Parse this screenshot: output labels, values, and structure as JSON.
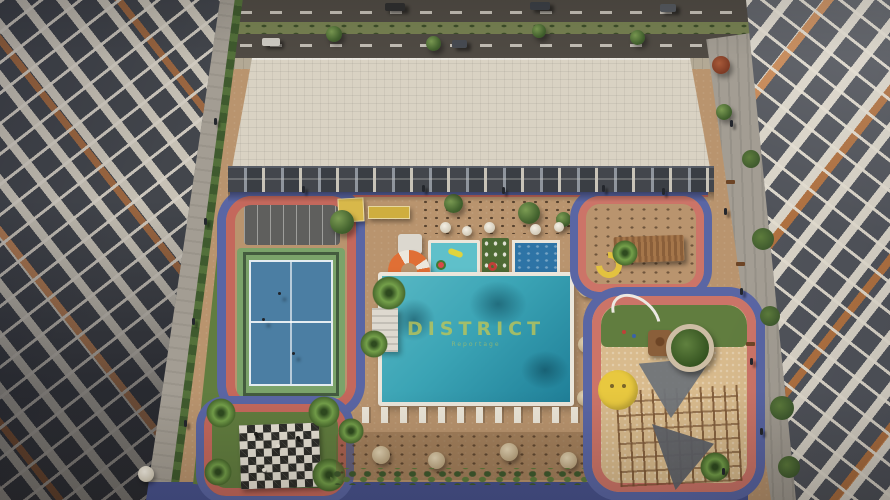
{
  "scene": {
    "description": "Aerial rendering of a residential community courtyard with pool, padel court, playground and amenities between apartment buildings",
    "watermark": {
      "title": "DISTRICT",
      "subtitle": "Reportage"
    }
  },
  "colors": {
    "deck": "#b9946e",
    "road": "#504b44",
    "median": "#778152",
    "sidewalk": "#b3a995",
    "roof": "#d9d2c3",
    "facade": "#33363b",
    "beam": "#c9c4b8",
    "windowDark": "#43464c",
    "accent": "#b26f3e",
    "track": "#c4685c",
    "trackPink": "#cc7468",
    "path": "#5a66a4",
    "pathDark": "#47528e",
    "grass": "#617d3f",
    "grassDark": "#4e6a34",
    "court": "#4b7ea3",
    "courtGreen": "#7ba36a",
    "pool": "#3ba4b5",
    "poolDeep": "#1f7f98",
    "poolRim": "#ebe6db",
    "kidsPool": "#5fc0ca",
    "plungePool": "#2e74a6",
    "sand": "#d9bb8d",
    "chessDark": "#2e2e2a",
    "chessLight": "#e6e1d4",
    "walkway": "#a39d93",
    "cabana": "#d8b84a",
    "lifebuoy": "#e06f35",
    "sail": "#70747a",
    "wood": "#8a5f3a",
    "planter": "#cdbda4",
    "smiley": "#e8c83f",
    "watermark": "#bdc558"
  }
}
